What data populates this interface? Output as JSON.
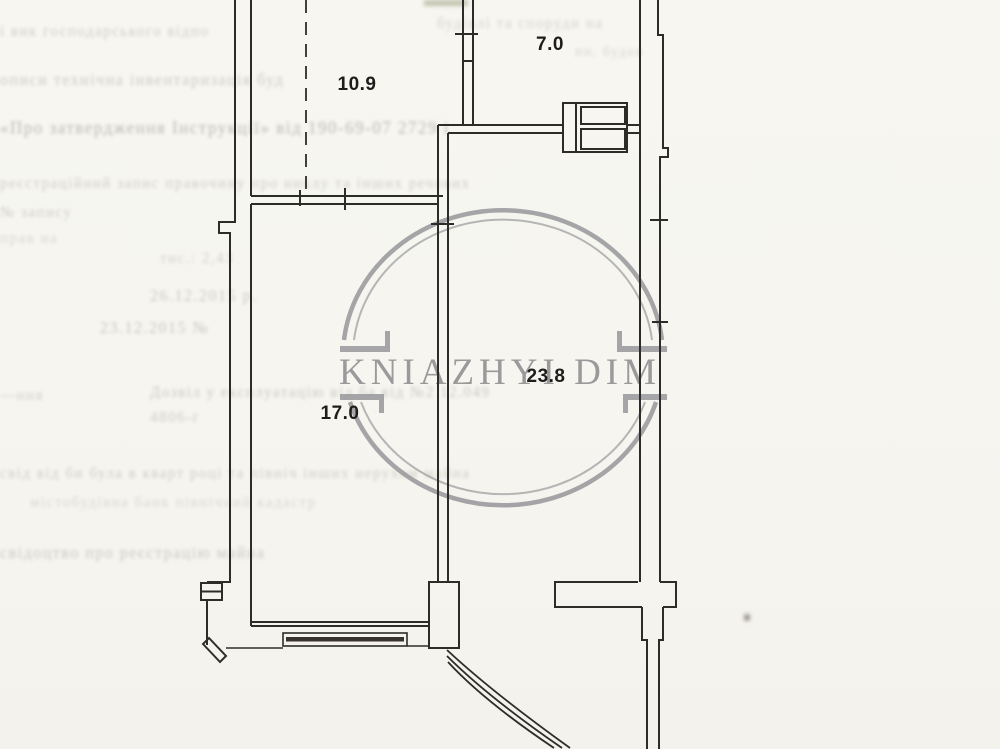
{
  "watermark": {
    "text": "KNIAZHYI DIM"
  },
  "rooms": [
    {
      "name": "room-10-9",
      "area": "10.9"
    },
    {
      "name": "room-7-0",
      "area": "7.0"
    },
    {
      "name": "room-23-8",
      "area": "23.8"
    },
    {
      "name": "room-17-0",
      "area": "17.0"
    }
  ],
  "colors": {
    "paper": "#f6f5f0",
    "ink": "#2e2c29",
    "watermark_gray": "#97979a",
    "faint_text": "#6d725c"
  },
  "faint_lines": [
    {
      "text": "і вик    господарського відпо",
      "x": 0,
      "y": 24,
      "w": 232,
      "fs": 15,
      "o": 0.3
    },
    {
      "text": "будівлі та  споруди  на",
      "x": 437,
      "y": 16,
      "w": 200,
      "fs": 15,
      "o": 0.26
    },
    {
      "text": "пн. будов",
      "x": 575,
      "y": 45,
      "w": 120,
      "fs": 14,
      "o": 0.24
    },
    {
      "text": "описи   технічна  інвентаризація  буд",
      "x": 0,
      "y": 72,
      "w": 405,
      "fs": 16,
      "o": 0.32
    },
    {
      "text": "«Про затвердження Інструкції» від 190-69-07 2729 і",
      "x": 0,
      "y": 118,
      "w": 462,
      "fs": 17,
      "o": 0.45
    },
    {
      "text": "реєстраційний  запис  правочину  про  никлу  та  інших  речових",
      "x": 0,
      "y": 176,
      "w": 700,
      "fs": 15,
      "o": 0.3
    },
    {
      "text": "№ запису",
      "x": 0,
      "y": 205,
      "w": 170,
      "fs": 15,
      "o": 0.3
    },
    {
      "text": "прав на",
      "x": 0,
      "y": 231,
      "w": 250,
      "fs": 15,
      "o": 0.24
    },
    {
      "text": "тис.: 2,43",
      "x": 160,
      "y": 251,
      "w": 170,
      "fs": 15,
      "o": 0.28
    },
    {
      "text": "26.12.2015 р.",
      "x": 150,
      "y": 288,
      "w": 185,
      "fs": 16,
      "o": 0.33
    },
    {
      "text": "23.12.2015 №",
      "x": 100,
      "y": 320,
      "w": 235,
      "fs": 16,
      "o": 0.35
    },
    {
      "text": "—ння",
      "x": 0,
      "y": 388,
      "w": 120,
      "fs": 15,
      "o": 0.28
    },
    {
      "text": "Дозвіл у експлуатацію від   ба   від   №2  12.049",
      "x": 150,
      "y": 385,
      "w": 612,
      "fs": 15,
      "o": 0.33
    },
    {
      "text": "4806-г",
      "x": 150,
      "y": 410,
      "w": 130,
      "fs": 15,
      "o": 0.3
    },
    {
      "text": "свід  від  би  була в  кварт  році  та  північ  інших  нерухом  майна",
      "x": 0,
      "y": 466,
      "w": 752,
      "fs": 15,
      "o": 0.3
    },
    {
      "text": "містобудівна   банк   північний  кадастр",
      "x": 30,
      "y": 495,
      "w": 640,
      "fs": 15,
      "o": 0.22
    },
    {
      "text": "свідоцтво про реєстрацію  майна",
      "x": 0,
      "y": 545,
      "w": 335,
      "fs": 16,
      "o": 0.33
    }
  ]
}
